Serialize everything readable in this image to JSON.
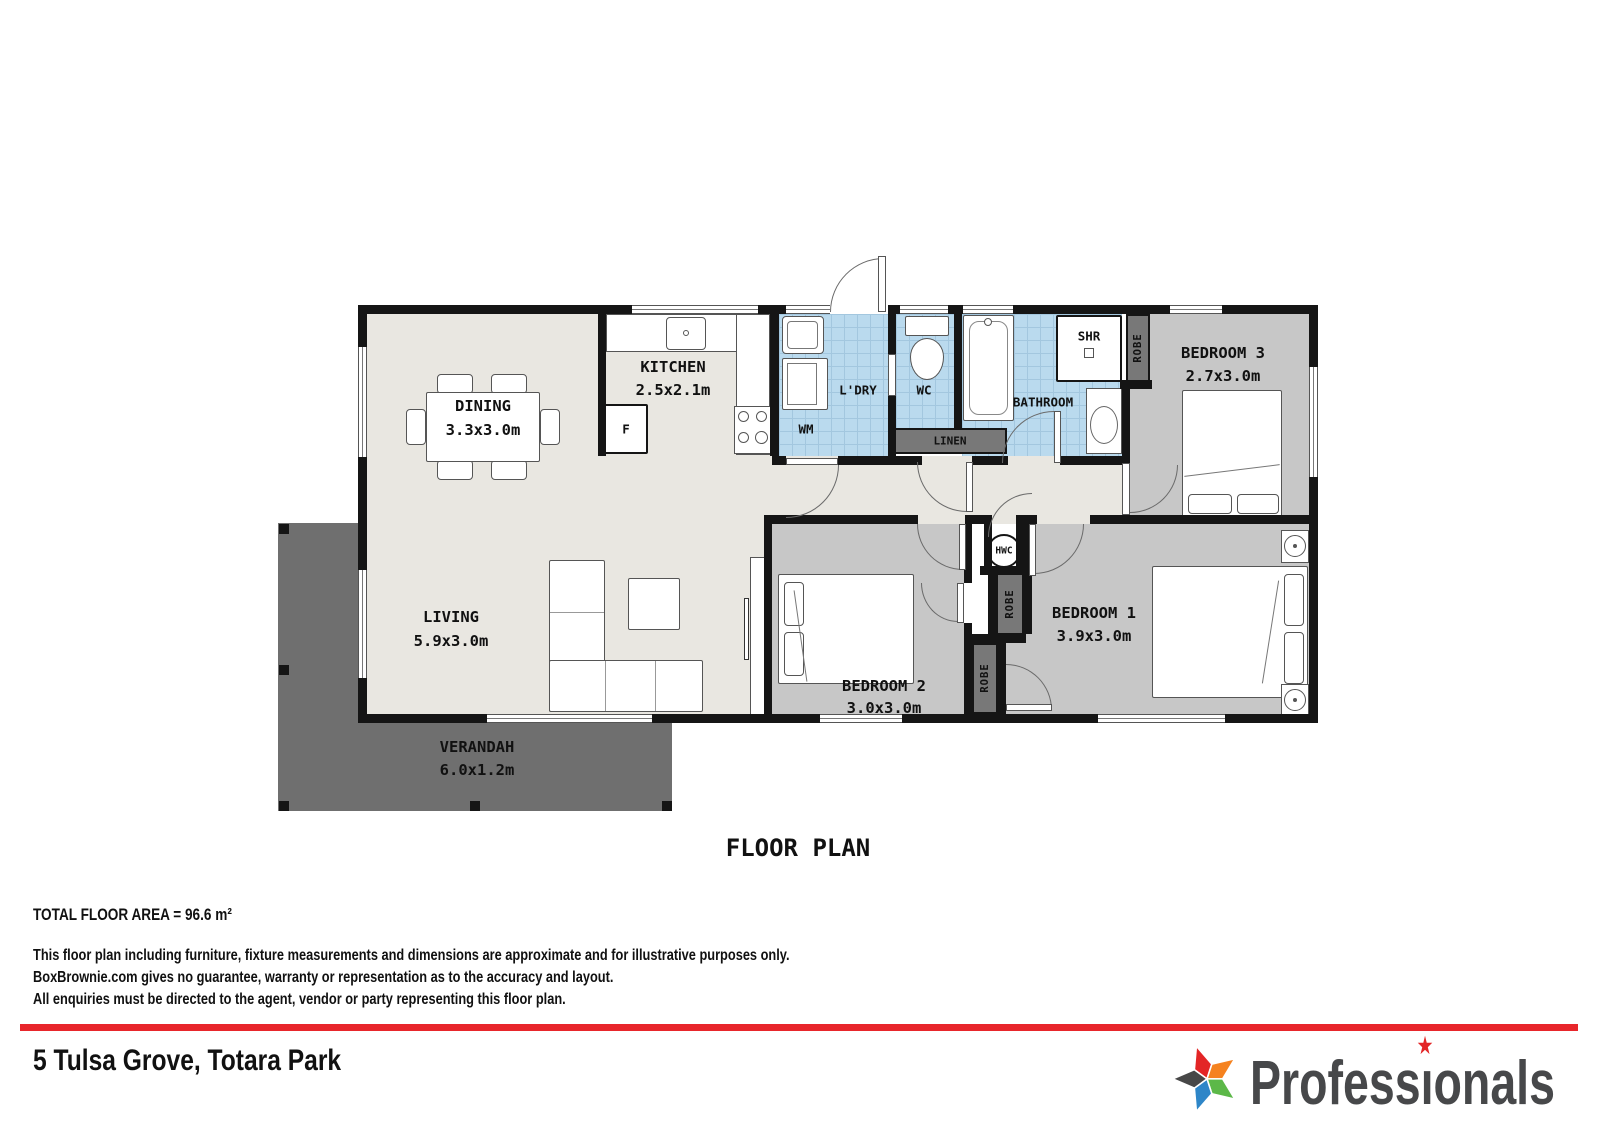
{
  "plan": {
    "title": "FLOOR PLAN",
    "rooms": {
      "dining": {
        "name": "DINING",
        "dims": "3.3x3.0m"
      },
      "kitchen": {
        "name": "KITCHEN",
        "dims": "2.5x2.1m"
      },
      "living": {
        "name": "LIVING",
        "dims": "5.9x3.0m"
      },
      "bedroom1": {
        "name": "BEDROOM 1",
        "dims": "3.9x3.0m"
      },
      "bedroom2": {
        "name": "BEDROOM 2",
        "dims": "3.0x3.0m"
      },
      "bedroom3": {
        "name": "BEDROOM 3",
        "dims": "2.7x3.0m"
      },
      "verandah": {
        "name": "VERANDAH",
        "dims": "6.0x1.2m"
      },
      "bathroom": {
        "name": "BATHROOM"
      },
      "laundry": {
        "name": "L'DRY"
      },
      "wc": {
        "name": "WC"
      }
    },
    "fixtures": {
      "fridge": "F",
      "washing_machine": "WM",
      "shower": "SHR",
      "hot_water_cylinder": "HWC",
      "linen": "LINEN",
      "robe": "ROBE"
    }
  },
  "footer": {
    "total_area": "TOTAL FLOOR AREA = 96.6 m²",
    "disclaimer": [
      "This floor plan including furniture, fixture measurements and dimensions are approximate and for illustrative purposes only.",
      "BoxBrownie.com gives no guarantee, warranty or representation as to the accuracy and layout.",
      "All enquiries must be directed to the agent, vendor or party representing this floor plan."
    ],
    "address": "5 Tulsa Grove, Totara Park"
  },
  "logo": {
    "brand_prefix": "Profess",
    "brand_i": "ı",
    "brand_suffix": "onals",
    "star_char": "★"
  },
  "colors": {
    "wall": "#151515",
    "floor_main": "#e9e7e1",
    "floor_bedroom": "#c7c7c7",
    "floor_wet_tile": "#badaee",
    "verandah": "#6f6f6f",
    "closet": "#787878",
    "accent_red": "#e8262b",
    "logo_text": "#47484a",
    "star_red": "#e32526",
    "star_orange": "#f5821f",
    "star_green": "#5cb848",
    "star_blue": "#2e86c8",
    "star_charcoal": "#474747"
  }
}
